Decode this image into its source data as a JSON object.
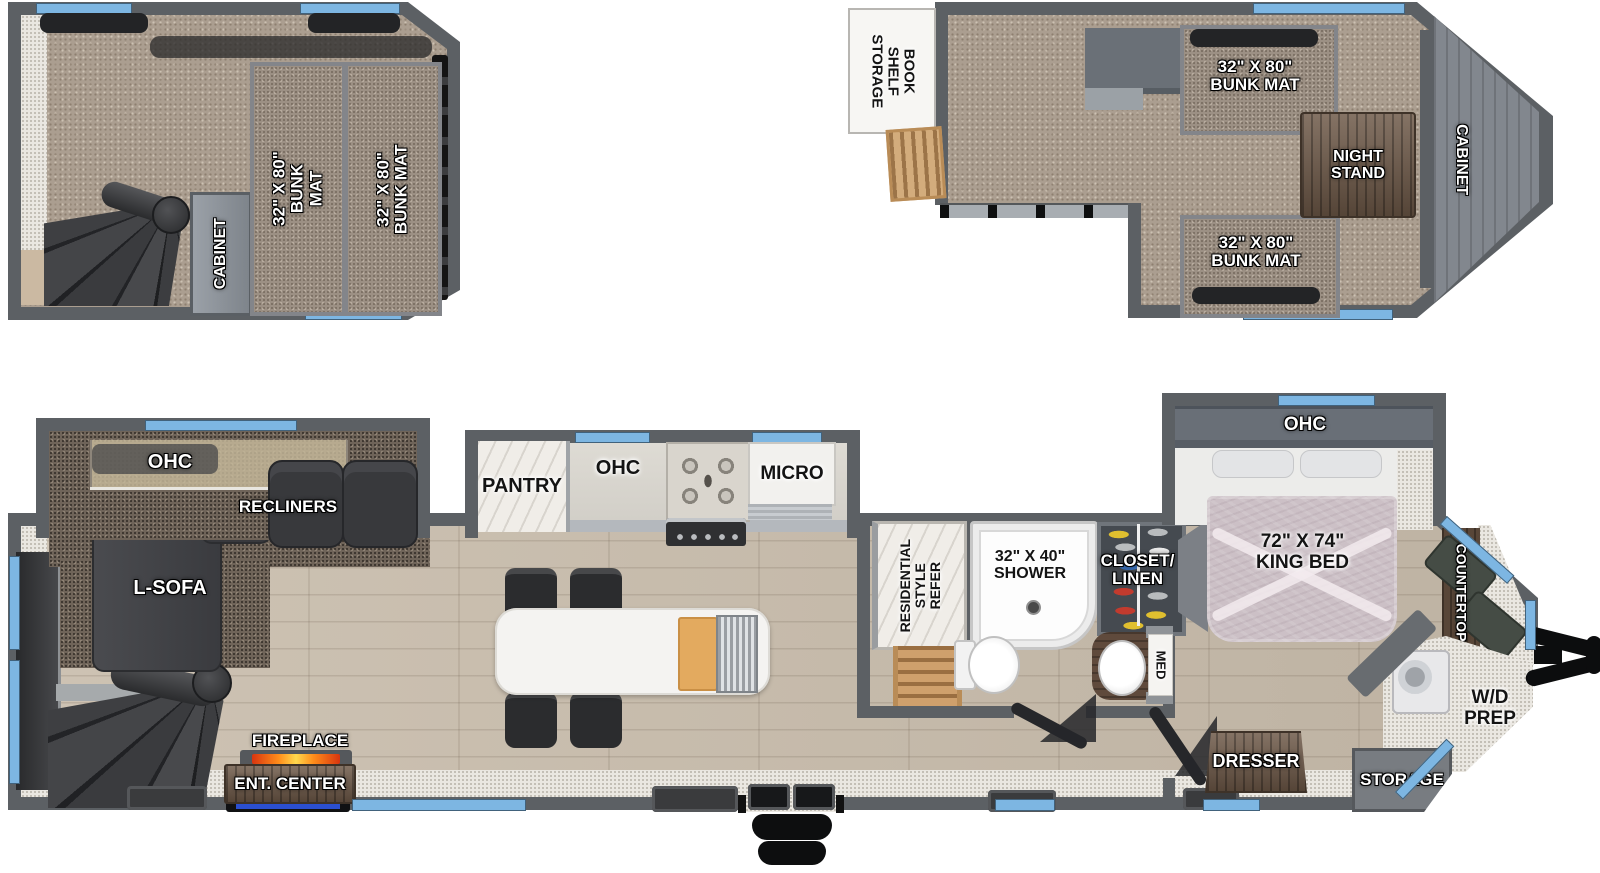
{
  "colors": {
    "wall": "#5c6064",
    "window_blue": "#7db6e2",
    "carpet": "#ab9e90",
    "wood_floor": "#c8bcab",
    "flame_orange": "#ff8c1a",
    "ent_mat_blue": "#2b4fd0",
    "bedspread_mauve": "#ccc0c6"
  },
  "rear_loft": {
    "cabinet_label": "CABINET",
    "bunk_left_label": "32\" X 80\"\nBUNK MAT",
    "bunk_right_label": "32\" X 80\"\nBUNK MAT"
  },
  "front_loft": {
    "bookshelf_label": "BOOK SHELF\nSTORAGE",
    "bunk_top_label": "32\" X 80\"\nBUNK MAT",
    "night_stand_label": "NIGHT\nSTAND",
    "bunk_bottom_label": "32\" X 80\"\nBUNK MAT",
    "cabinet_label": "CABINET"
  },
  "living": {
    "ohc_label": "OHC",
    "recliners_label": "RECLINERS",
    "l_sofa_label": "L-SOFA",
    "fireplace_label": "FIREPLACE",
    "ent_center_label": "ENT. CENTER"
  },
  "kitchen": {
    "pantry_label": "PANTRY",
    "ohc_label": "OHC",
    "micro_label": "MICRO"
  },
  "bath": {
    "refer_label": "RESIDENTIAL\nSTYLE\nREFER",
    "shower_label": "32\" X 40\"\nSHOWER",
    "closet_label": "CLOSET/\nLINEN",
    "med_label": "MED"
  },
  "bedroom": {
    "ohc_label": "OHC",
    "king_bed_label": "72\" X 74\"\nKING BED",
    "dresser_label": "DRESSER"
  },
  "front_cap": {
    "countertop_label": "COUNTERTOP",
    "wd_prep_label": "W/D\nPREP",
    "storage_label": "STORAGE"
  }
}
